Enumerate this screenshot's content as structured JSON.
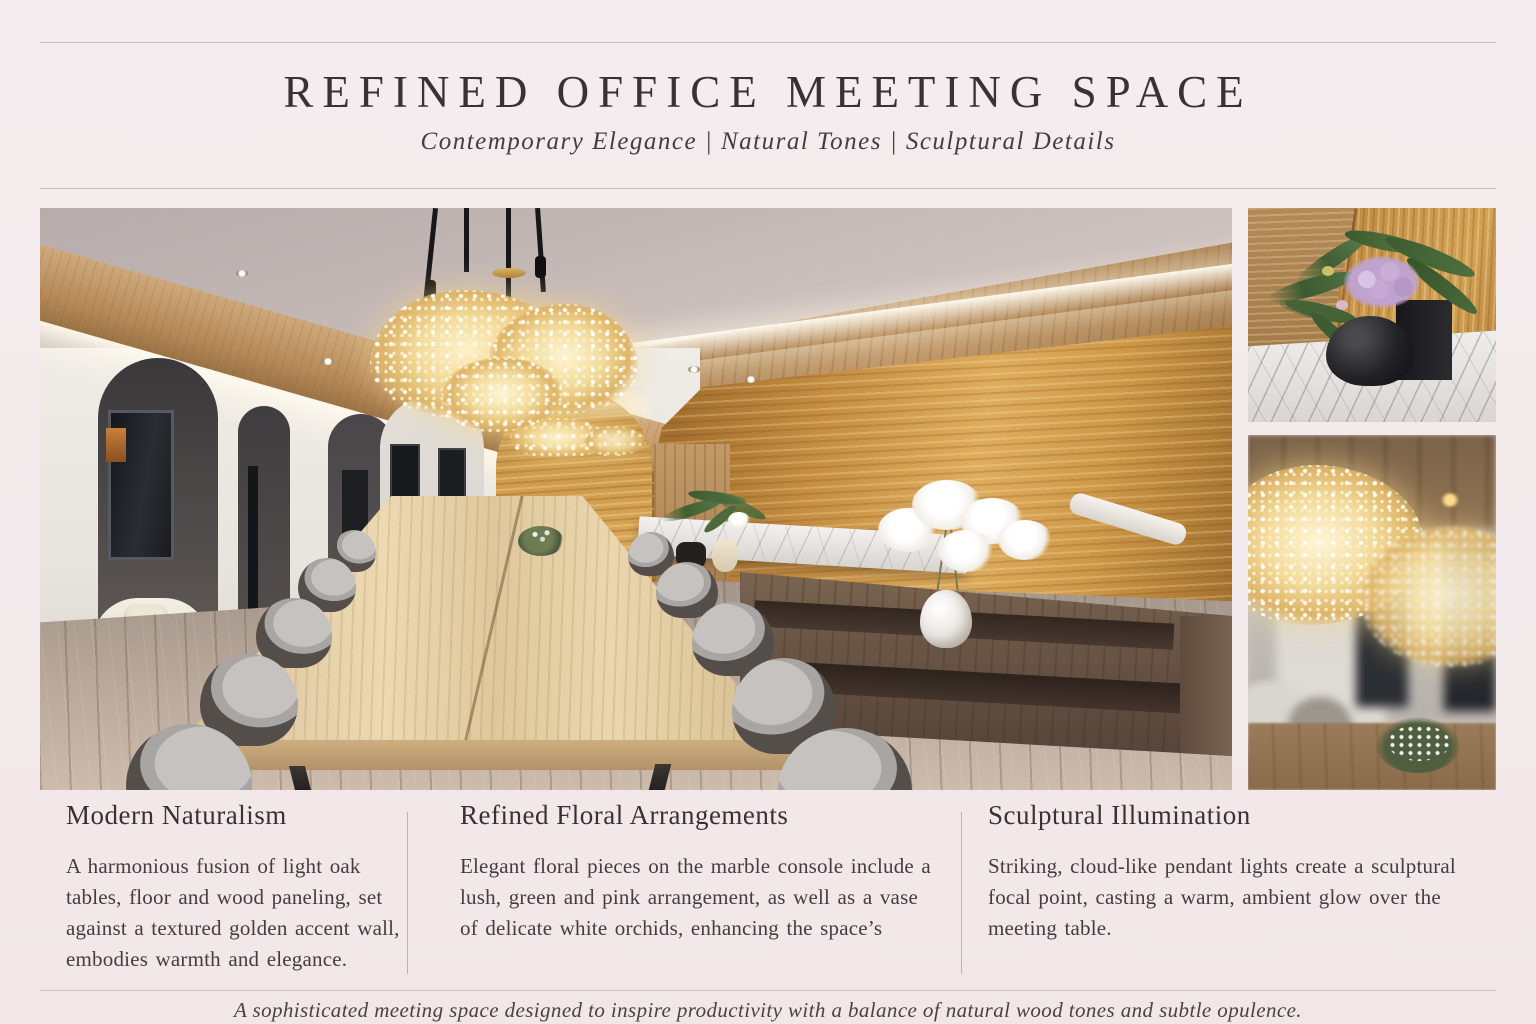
{
  "page": {
    "title": "REFINED OFFICE MEETING SPACE",
    "subtitle": "Contemporary Elegance | Natural Tones | Sculptural Details",
    "footer": "A sophisticated meeting space designed to inspire productivity with a balance of natural wood tones and subtle opulence."
  },
  "features": [
    {
      "heading": "Modern Naturalism",
      "body": "A harmonious fusion of light oak tables, floor and wood paneling, set against a textured golden accent wall, embodies warmth and elegance."
    },
    {
      "heading": "Refined Floral Arrangements",
      "body": "Elegant floral pieces on the marble console include a lush, green and pink arrangement, as well as a vase of delicate white orchids, enhancing the space’s"
    },
    {
      "heading": "Sculptural Illumination",
      "body": "Striking, cloud-like pendant lights create a sculptural focal point, casting a warm, ambient glow over the meeting table."
    }
  ],
  "images": {
    "main": "office-meeting-room-photo",
    "detail_top": "floral-arrangement-photo",
    "detail_bottom": "pendant-light-photo"
  },
  "palette": {
    "background": "#f3ebec",
    "text": "#3a3136",
    "rule": "#c9bfc2",
    "gold_accent": "#d9a757",
    "oak": "#e4cfa6",
    "walnut": "#6a5545"
  }
}
